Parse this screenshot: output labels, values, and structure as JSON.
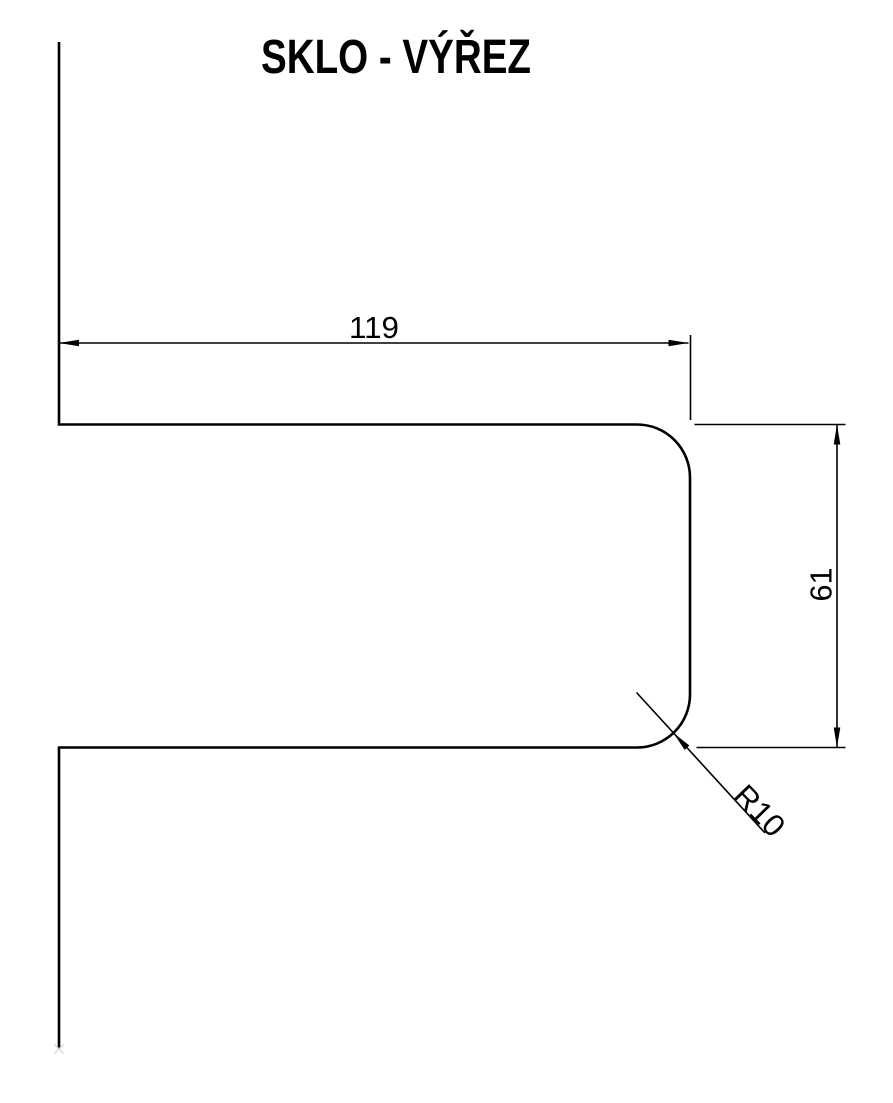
{
  "colors": {
    "line": "#000000",
    "background": "#ffffff",
    "faint_marker": "#d8d8d8"
  },
  "header": {
    "title": "SKLO - VÝŘEZ"
  },
  "drawing": {
    "type": "technical-drawing-glass-cutout",
    "dimensions": {
      "width": {
        "label": "119",
        "orientation": "horizontal"
      },
      "height": {
        "label": "61",
        "orientation": "vertical"
      },
      "corner_radius": {
        "label": "R10",
        "orientation": "diagonal-leader"
      }
    }
  }
}
